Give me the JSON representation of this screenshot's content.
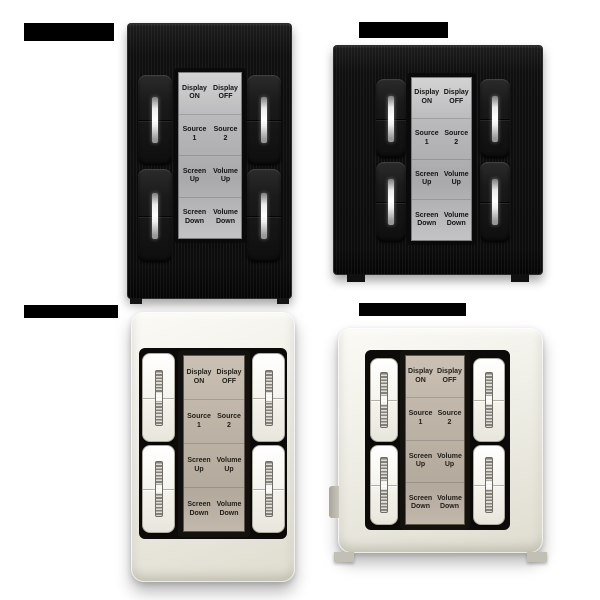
{
  "collage": {
    "background": "#ffffff",
    "panel_count": 4,
    "redacted_caption_count": 4
  },
  "keypad_labels": {
    "rows": [
      {
        "left": [
          "Display",
          "ON"
        ],
        "right": [
          "Display",
          "OFF"
        ]
      },
      {
        "left": [
          "Source",
          "1"
        ],
        "right": [
          "Source",
          "2"
        ]
      },
      {
        "left": [
          "Screen",
          "Up"
        ],
        "right": [
          "Volume",
          "Up"
        ]
      },
      {
        "left": [
          "Screen",
          "Down"
        ],
        "right": [
          "Volume",
          "Down"
        ]
      }
    ]
  },
  "panels": [
    {
      "name": "keypad-black-portrait",
      "finish": "black",
      "shape": "portrait",
      "left_buttons": [
        "display-on",
        "source-1",
        "screen-up",
        "screen-down"
      ],
      "right_buttons": [
        "display-off",
        "source-2",
        "volume-up",
        "volume-down"
      ]
    },
    {
      "name": "keypad-black-square",
      "finish": "black",
      "shape": "square",
      "left_buttons": [
        "display-on",
        "source-1",
        "screen-up",
        "screen-down"
      ],
      "right_buttons": [
        "display-off",
        "source-2",
        "volume-up",
        "volume-down"
      ]
    },
    {
      "name": "keypad-white-portrait",
      "finish": "white",
      "shape": "portrait",
      "left_buttons": [
        "display-on",
        "source-1",
        "screen-up",
        "screen-down"
      ],
      "right_buttons": [
        "display-off",
        "source-2",
        "volume-up",
        "volume-down"
      ]
    },
    {
      "name": "keypad-white-square",
      "finish": "white",
      "shape": "square",
      "left_buttons": [
        "display-on",
        "source-1",
        "screen-up",
        "screen-down"
      ],
      "right_buttons": [
        "display-off",
        "source-2",
        "volume-up",
        "volume-down"
      ]
    }
  ],
  "colors": {
    "black_plate": "#0c0c0c",
    "black_button": "#1a1a1a",
    "silver_label_plate": "#b9b9bb",
    "white_plate": "#efeee6",
    "white_button": "#f6f5ef",
    "beige_label_plate": "#bdb3a6",
    "label_text_on_silver": "#131313",
    "label_text_on_beige": "#23201b",
    "led_indicator_light": "#ffffff"
  }
}
